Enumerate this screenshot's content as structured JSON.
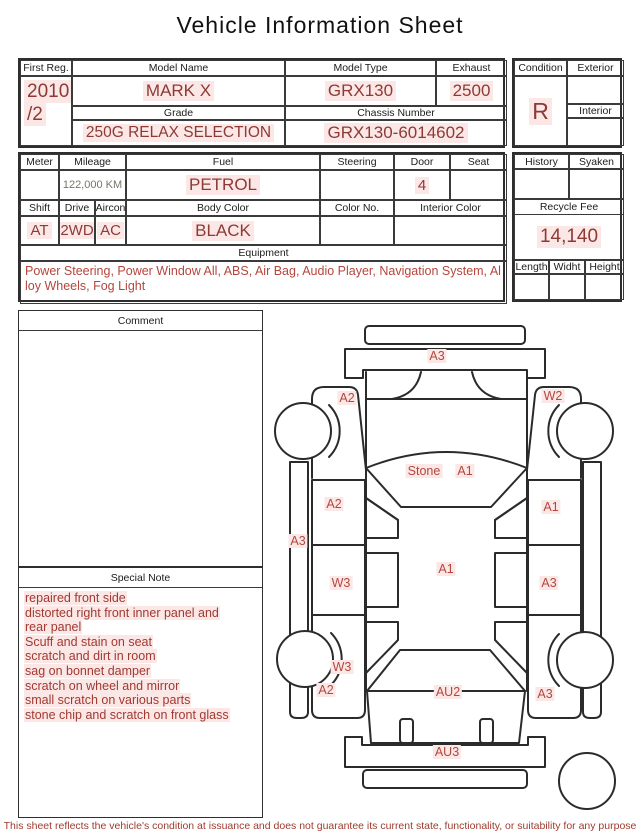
{
  "title": "Vehicle Information Sheet",
  "colors": {
    "value_red": "#8d3a34",
    "note_red": "#a03a31",
    "label_red": "#b2483d",
    "highlight_pink": "#fce7e7",
    "border": "#2e2e2e"
  },
  "table1": {
    "first_reg": {
      "label": "First Reg.",
      "value_line1": "2010",
      "value_line2": "/2"
    },
    "model_name": {
      "label": "Model Name",
      "value": "MARK X"
    },
    "model_type": {
      "label": "Model Type",
      "value": "GRX130"
    },
    "exhaust": {
      "label": "Exhaust",
      "value": "2500"
    },
    "grade": {
      "label": "Grade",
      "value": "250G RELAX SELECTION"
    },
    "chassis": {
      "label": "Chassis Number",
      "value": "GRX130-6014602"
    }
  },
  "condition_panel": {
    "condition_label": "Condition",
    "condition_value": "R",
    "exterior_label": "Exterior",
    "interior_label": "Interior"
  },
  "table2": {
    "meter_label": "Meter",
    "mileage": {
      "label": "Mileage",
      "value": "122,000 KM"
    },
    "fuel": {
      "label": "Fuel",
      "value": "PETROL"
    },
    "steering_label": "Steering",
    "door": {
      "label": "Door",
      "value": "4"
    },
    "seat_label": "Seat",
    "shift": {
      "label": "Shift",
      "value": "AT"
    },
    "drive": {
      "label": "Drive",
      "value": "2WD"
    },
    "aircon": {
      "label": "Aircon",
      "value": "AC"
    },
    "body_color": {
      "label": "Body Color",
      "value": "BLACK"
    },
    "color_no_label": "Color No.",
    "interior_color_label": "Interior Color",
    "equipment": {
      "label": "Equipment",
      "line1": "Power Steering, Power Window  All, ABS, Air Bag, Audio Player, Navigation System, Al",
      "line2": "loy Wheels, Fog Light"
    }
  },
  "fee_panel": {
    "history_label": "History",
    "syaken_label": "Syaken",
    "recycle_fee_label": "Recycle Fee",
    "recycle_fee_value": "14,140",
    "length_label": "Length",
    "width_label": "Widht",
    "height_label": "Height"
  },
  "comment": {
    "label": "Comment"
  },
  "special_note": {
    "label": "Special Note",
    "lines": [
      "repaired front side",
      "distorted right front inner panel and",
      "rear panel",
      "Scuff and stain on seat",
      "scratch and dirt in room",
      "sag on bonnet damper",
      "scratch on wheel and mirror",
      "small scratch on various parts",
      "stone chip and scratch on front glass"
    ]
  },
  "diagram": {
    "labels": [
      {
        "area": "front-bumper",
        "text": "A3"
      },
      {
        "area": "left-front-fender",
        "text": "A2"
      },
      {
        "area": "right-front-fender",
        "text": "W2"
      },
      {
        "area": "windshield-note",
        "text": "Stone"
      },
      {
        "area": "windshield",
        "text": "A1"
      },
      {
        "area": "left-front-door",
        "text": "A2"
      },
      {
        "area": "right-front-door",
        "text": "A1"
      },
      {
        "area": "left-sill",
        "text": "A3"
      },
      {
        "area": "roof",
        "text": "A1"
      },
      {
        "area": "left-rear-door",
        "text": "W3"
      },
      {
        "area": "right-rear-door",
        "text": "A3"
      },
      {
        "area": "left-rear-wheel",
        "text": "W3"
      },
      {
        "area": "left-rear-quarter",
        "text": "A2"
      },
      {
        "area": "rear-window",
        "text": "AU2"
      },
      {
        "area": "right-rear-quarter",
        "text": "A3"
      },
      {
        "area": "rear-bumper",
        "text": "AU3"
      }
    ]
  },
  "footer": {
    "disclaimer": "This sheet reflects the vehicle's condition at issuance and does not guarantee its current state, functionality, or suitability for any purpose"
  }
}
